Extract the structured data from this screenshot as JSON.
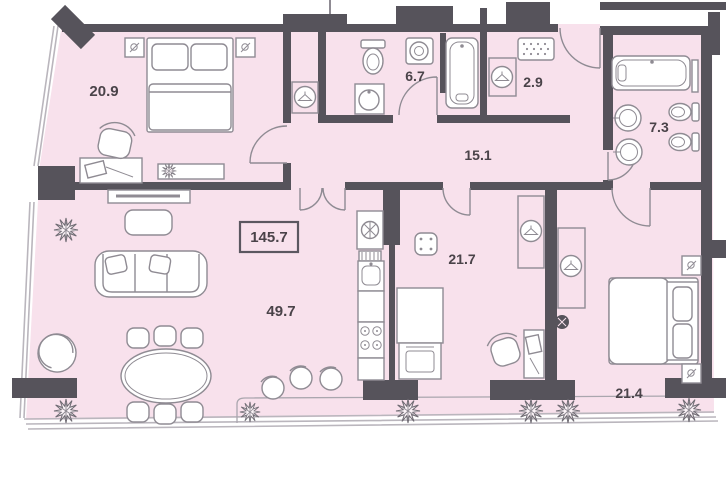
{
  "plan": {
    "title": "apartment-floor-plan",
    "total_area": "145.7",
    "rooms": [
      {
        "id": "bedroom-1",
        "area": "20.9"
      },
      {
        "id": "bathroom-1",
        "area": "6.7"
      },
      {
        "id": "entry",
        "area": "2.9"
      },
      {
        "id": "bathroom-2",
        "area": "7.3"
      },
      {
        "id": "hallway",
        "area": "15.1"
      },
      {
        "id": "living-room",
        "area": "49.7"
      },
      {
        "id": "kitchen",
        "area": "21.7"
      },
      {
        "id": "bedroom-2",
        "area": "21.4"
      }
    ],
    "symbols": {
      "tree": "spiky-circle plant",
      "hanger-circle": "wardrobe with clothes-hanger",
      "door-arc": "door swing quarter circle",
      "doormat": "dotted rectangle at entrance"
    },
    "colors": {
      "floor": "#f8e1ec",
      "walls": "#56535b",
      "furniture": "#8f8b93",
      "labels": "#4a4349",
      "glazing": "#bab6bd",
      "background": "#ffffff"
    }
  }
}
